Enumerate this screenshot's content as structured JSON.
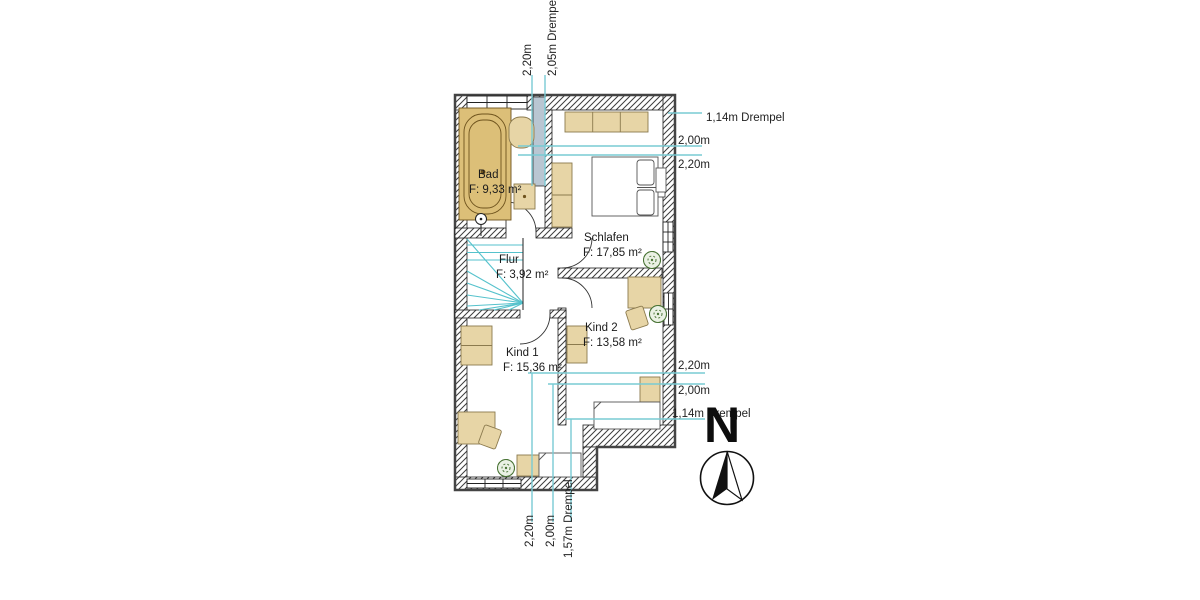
{
  "rooms": [
    {
      "name": "Bad",
      "area": "F: 9,33 m²"
    },
    {
      "name": "Schlafen",
      "area": "F: 17,85 m²"
    },
    {
      "name": "Flur",
      "area": "F: 3,92 m²"
    },
    {
      "name": "Kind 1",
      "area": "F: 15,36 m²"
    },
    {
      "name": "Kind 2",
      "area": "F: 13,58 m²"
    }
  ],
  "dims": {
    "top": [
      "2,20m",
      "2,05m Drempel"
    ],
    "right_upper": [
      "1,14m Drempel",
      "2,00m",
      "2,20m"
    ],
    "right_lower": [
      "2,20m",
      "2,00m",
      "1,14m Drempel"
    ],
    "bottom": [
      "2,20m",
      "2,00m",
      "1,57m Drempel"
    ]
  },
  "compass": {
    "north_label": "N"
  },
  "colors": {
    "dimension_line": "#79cbd4",
    "stair_line": "#55c2cc",
    "furniture_fill": "#e7d5a6",
    "bathtub_fill": "#dcbf78",
    "plant_green": "#4a7436",
    "shaft_fill": "#b9c6d2",
    "wall_line": "#3f3f3f"
  }
}
